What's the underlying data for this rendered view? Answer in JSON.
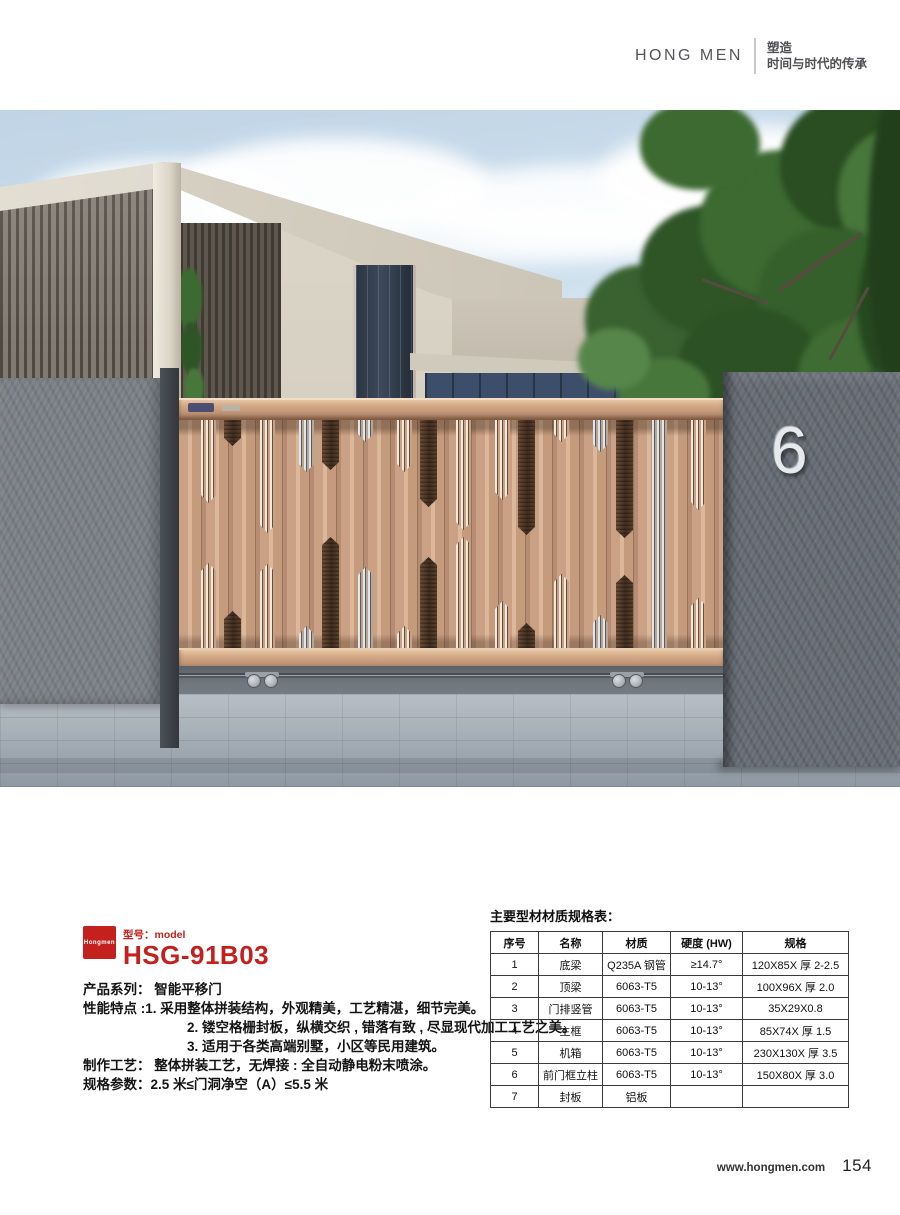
{
  "header": {
    "brand": "HONG MEN",
    "tagline_line1": "塑造",
    "tagline_line2": "时间与时代的传承"
  },
  "photo": {
    "house_number": "6"
  },
  "product": {
    "logo_text": "Hongmen",
    "model_label": "型号：model",
    "model": "HSG-91B03",
    "lines": [
      {
        "text": "产品系列： 智能平移门",
        "indent": 0
      },
      {
        "text": "性能特点 :1. 采用整体拼装结构，外观精美，工艺精湛，细节完美。",
        "indent": 0
      },
      {
        "text": "2. 镂空格栅封板，纵横交织 , 错落有致 , 尽显现代加工工艺之美。",
        "indent": 1
      },
      {
        "text": "3. 适用于各类高端别墅，小区等民用建筑。",
        "indent": 1
      },
      {
        "text": "制作工艺： 整体拼装工艺，无焊接 : 全自动静电粉末喷涂。",
        "indent": 0
      },
      {
        "text": "规格参数：2.5 米≤门洞净空（A）≤5.5 米",
        "indent": 0
      }
    ]
  },
  "spec_table": {
    "title": "主要型材材质规格表：",
    "headers": [
      "序号",
      "名称",
      "材质",
      "硬度 (HW)",
      "规格"
    ],
    "rows": [
      [
        "1",
        "底梁",
        "Q235A 钢管",
        "≥14.7°",
        "120X85X 厚 2-2.5"
      ],
      [
        "2",
        "顶梁",
        "6063-T5",
        "10-13°",
        "100X96X 厚 2.0"
      ],
      [
        "3",
        "门排竖管",
        "6063-T5",
        "10-13°",
        "35X29X0.8"
      ],
      [
        "4",
        "主框",
        "6063-T5",
        "10-13°",
        "85X74X 厚 1.5"
      ],
      [
        "5",
        "机箱",
        "6063-T5",
        "10-13°",
        "230X130X 厚 3.5"
      ],
      [
        "6",
        "前门框立柱",
        "6063-T5",
        "10-13°",
        "150X80X 厚 3.0"
      ],
      [
        "7",
        "封板",
        "铝板",
        "",
        ""
      ]
    ]
  },
  "footer": {
    "website": "www.hongmen.com",
    "page_number": "154"
  },
  "colors": {
    "brand_red": "#c4201d",
    "gate_copper": "#c79e83",
    "wall_gray": "#7b8086",
    "sky_blue": "#c9dcec"
  }
}
